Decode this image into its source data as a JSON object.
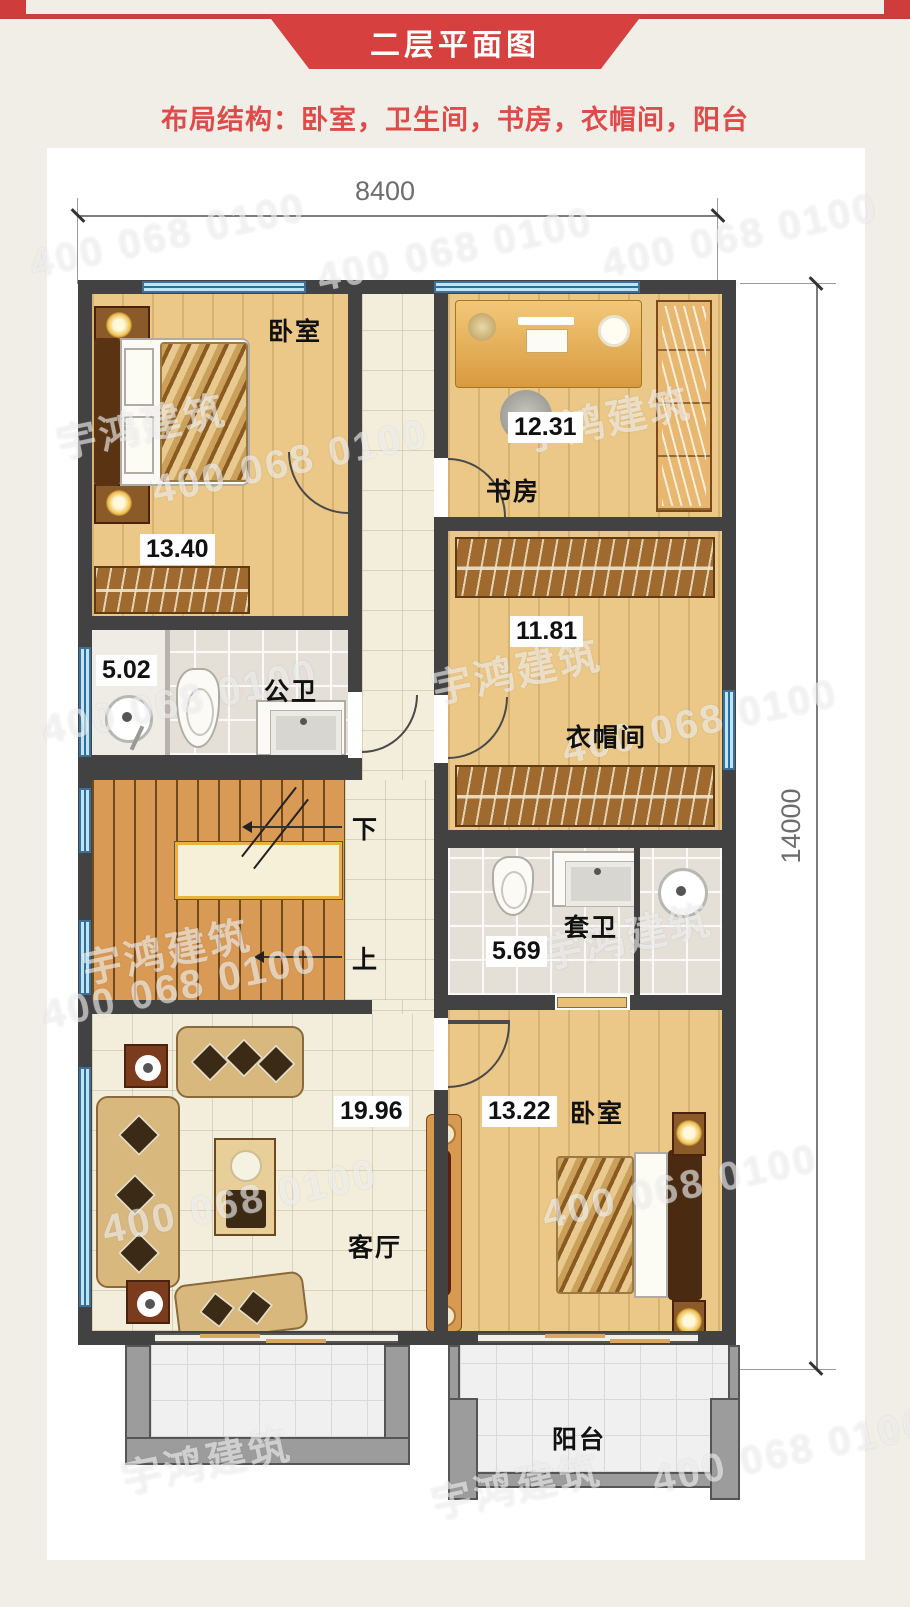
{
  "header": {
    "title": "二层平面图",
    "subtitle": "布局结构：卧室，卫生间，书房，衣帽间，阳台"
  },
  "dimensions": {
    "width_mm": "8400",
    "height_mm": "14000"
  },
  "rooms": {
    "bedroom1": {
      "label": "卧室",
      "area": "13.40"
    },
    "study": {
      "label": "书房",
      "area": "12.31"
    },
    "public_bath": {
      "label": "公卫",
      "area": "5.02"
    },
    "cloakroom": {
      "label": "衣帽间",
      "area": "11.81"
    },
    "ensuite_bath": {
      "label": "套卫",
      "area": "5.69"
    },
    "living": {
      "label": "客厅",
      "area": "19.96"
    },
    "bedroom2": {
      "label": "卧室",
      "area": "13.22"
    },
    "balcony": {
      "label": "阳台"
    }
  },
  "stairs": {
    "down": "下",
    "up": "上"
  },
  "watermark": {
    "brand": "宇鸿建筑",
    "phone": "400 068 0100"
  },
  "furniture_icons": [
    "double-bed",
    "nightstand-lamp",
    "wardrobe-hangers",
    "desk",
    "office-chair",
    "bookshelf",
    "shower",
    "toilet",
    "sink-vanity",
    "sofa-set",
    "coffee-table",
    "tv-console",
    "stairs"
  ],
  "colors": {
    "accent_red": "#d6403e",
    "subtitle_red": "#df4b4a",
    "wall": "#424242",
    "window_blue": "#bfe4f8",
    "window_frame": "#3c7097",
    "wood_floor": "#ebc887",
    "tile_cream": "#f3eedb",
    "tile_bath": "#e4e0d8",
    "balcony_gray": "#9c9c9c",
    "stair_wood": "#d89a55",
    "card_bg": "#ffffff",
    "page_bg": "#f1eee7"
  }
}
